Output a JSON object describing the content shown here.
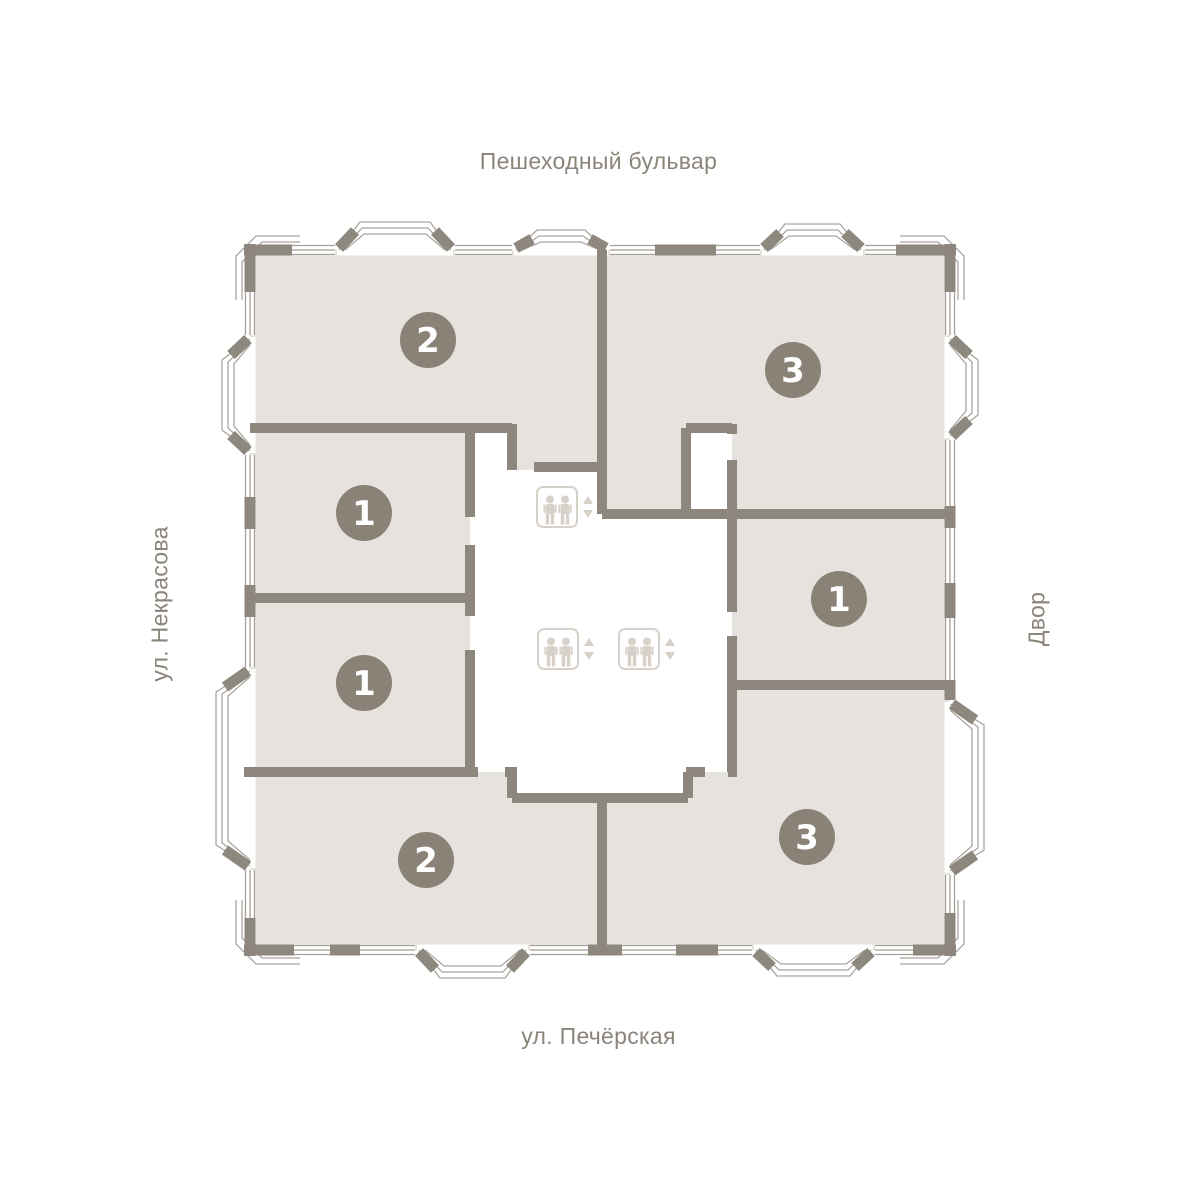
{
  "title": "Поэтажный план",
  "streets": {
    "top": "Пешеходный бульвар",
    "bottom": "ул. Печёрская",
    "left": "ул. Некрасова",
    "right": "Двор"
  },
  "apartments": [
    {
      "name": "apartment-top-left",
      "rooms": "2"
    },
    {
      "name": "apartment-top-right",
      "rooms": "3"
    },
    {
      "name": "apartment-left-upper",
      "rooms": "1"
    },
    {
      "name": "apartment-left-lower",
      "rooms": "1"
    },
    {
      "name": "apartment-right-middle",
      "rooms": "1"
    },
    {
      "name": "apartment-bottom-left",
      "rooms": "2"
    },
    {
      "name": "apartment-bottom-right",
      "rooms": "3"
    }
  ],
  "elevators": {
    "count": 3,
    "icon": "elevator-icon"
  },
  "colors": {
    "background": "#ffffff",
    "room_fill": "#e6e3de",
    "wall": "#8e877d",
    "badge": "#8a8277",
    "badge_text": "#ffffff",
    "elevator_icon": "#d7d1c9",
    "street_text": "#8a847a"
  }
}
